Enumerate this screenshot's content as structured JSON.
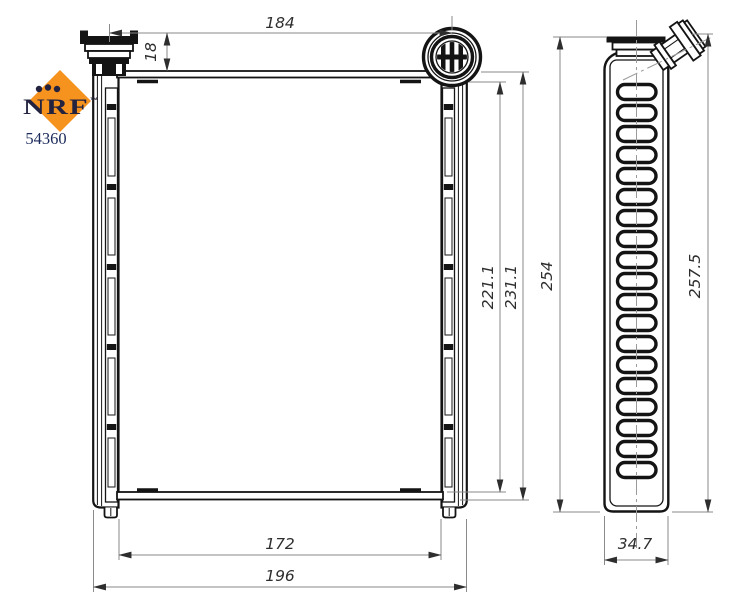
{
  "brand": {
    "logo_text": "NRF",
    "trademark_symbol": "™",
    "part_number": "54360",
    "colors": {
      "orange": "#F6921E",
      "navy": "#23233F",
      "part_number_blue": "#1C2B5C"
    }
  },
  "dimensions": {
    "port_center_distance": "184",
    "port_height": "18",
    "core_height": "221.1",
    "overall_height": "231.1",
    "core_width": "172",
    "overall_width": "196",
    "side_body_height": "254",
    "side_overall_height": "257.5",
    "side_depth": "34.7"
  }
}
